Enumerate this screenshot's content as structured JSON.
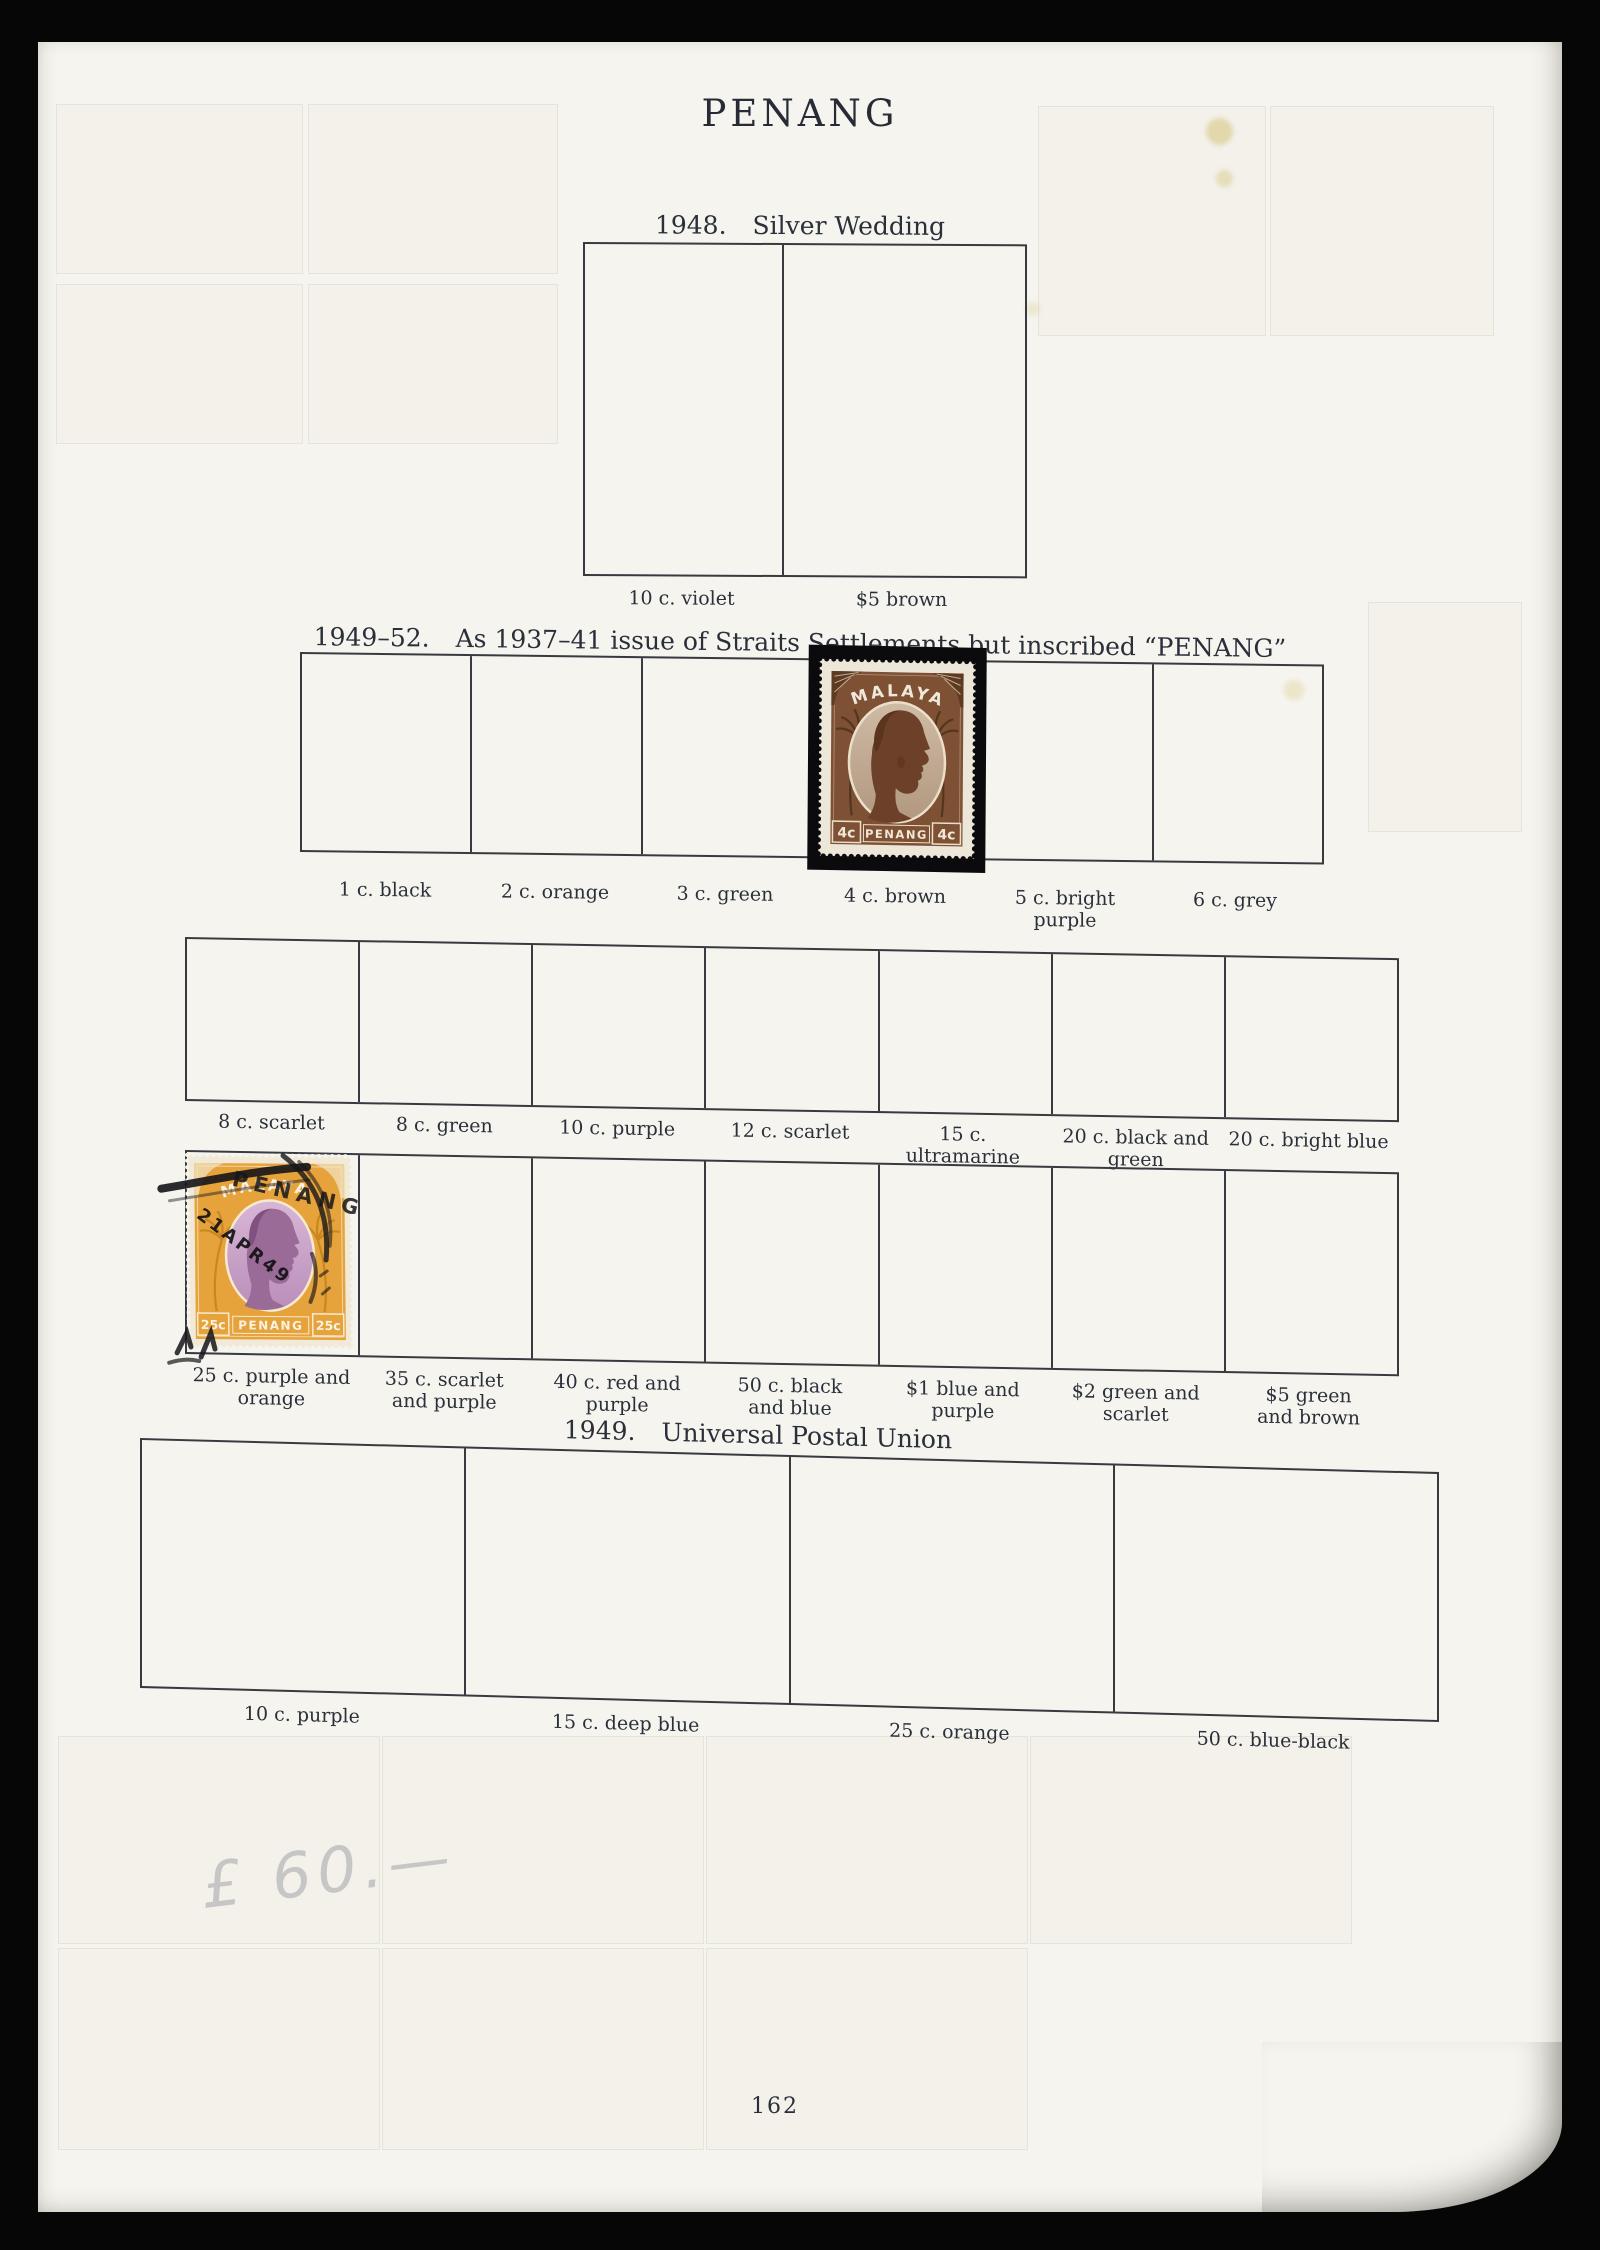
{
  "page": {
    "title": "PENANG",
    "number": "162",
    "handwritten_note": "£ 60.—"
  },
  "sections": {
    "silver_wedding": {
      "year": "1948.",
      "title": "Silver Wedding",
      "labels": [
        "10 c. violet",
        "$5 brown"
      ]
    },
    "definitives": {
      "year": "1949–52.",
      "title": "As 1937–41 issue of Straits Settlements but inscribed “PENANG”",
      "row1": [
        "1 c. black",
        "2 c. orange",
        "3 c. green",
        "4 c. brown",
        "5 c. bright purple",
        "6 c. grey"
      ],
      "row2": [
        "8 c. scarlet",
        "8 c. green",
        "10 c. purple",
        "12 c. scarlet",
        "15 c. ultramarine",
        "20 c. black and green",
        "20 c. bright blue"
      ],
      "row3": [
        "25 c. purple and orange",
        "35 c. scarlet and purple",
        "40 c. red and purple",
        "50 c. black and blue",
        "$1 blue and purple",
        "$2 green and scarlet",
        "$5 green and brown"
      ]
    },
    "upu": {
      "year": "1949.",
      "title": "Universal Postal Union",
      "labels": [
        "10 c. purple",
        "15 c. deep blue",
        "25 c. orange",
        "50 c. blue-black"
      ]
    }
  },
  "stamps": {
    "brown_4c": {
      "country": "MALAYA",
      "territory": "PENANG",
      "value": "4c"
    },
    "orange_25c": {
      "country": "MALAYA",
      "territory": "PENANG",
      "value": "25c",
      "postmark_town": "PENANG",
      "postmark_date": "21APR49"
    }
  }
}
